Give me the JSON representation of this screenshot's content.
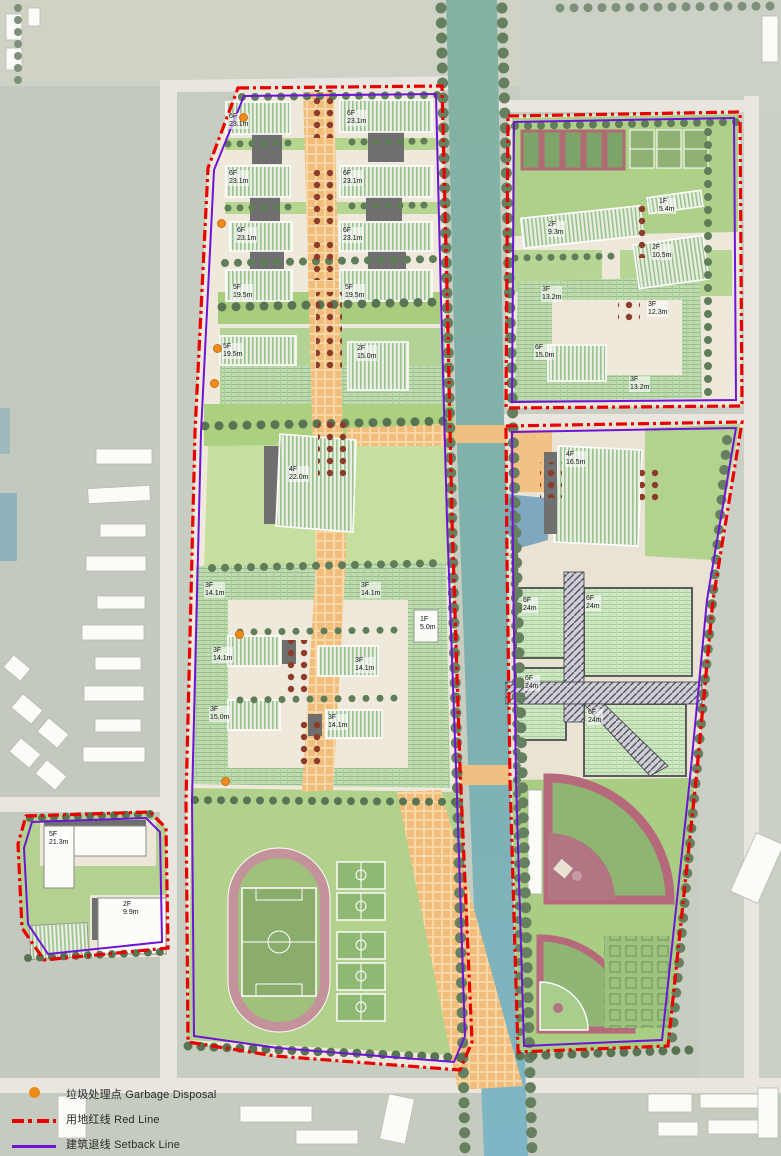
{
  "legend": {
    "items": [
      {
        "id": "garbage-disposal",
        "label_zh": "垃圾处理点",
        "label_en": "Garbage Disposal",
        "color": "#ef8b1d"
      },
      {
        "id": "red-line",
        "label_zh": "用地红线",
        "label_en": "Red Line",
        "color": "#e90000"
      },
      {
        "id": "setback-line",
        "label_zh": "建筑退线",
        "label_en": "Setback Line",
        "color": "#6d14d8"
      }
    ]
  },
  "colors": {
    "water": "#7fb0ad",
    "parcel_ground": "#efe9dc",
    "lawn": "#aed089",
    "axis_orange": "#f2bd7a",
    "track_pink": "#c4929b",
    "red_line": "#e90000",
    "setback_line": "#6d14d8",
    "garbage_dot": "#ef8b1d"
  },
  "building_labels": [
    {
      "floors": "6F",
      "height": "23.1m",
      "x": 228,
      "y": 113
    },
    {
      "floors": "6F",
      "height": "23.1m",
      "x": 346,
      "y": 110
    },
    {
      "floors": "6F",
      "height": "23.1m",
      "x": 228,
      "y": 170
    },
    {
      "floors": "6F",
      "height": "23.1m",
      "x": 342,
      "y": 170
    },
    {
      "floors": "6F",
      "height": "23.1m",
      "x": 236,
      "y": 227
    },
    {
      "floors": "6F",
      "height": "23.1m",
      "x": 342,
      "y": 227
    },
    {
      "floors": "5F",
      "height": "19.5m",
      "x": 232,
      "y": 284
    },
    {
      "floors": "5F",
      "height": "19.5m",
      "x": 344,
      "y": 284
    },
    {
      "floors": "5F",
      "height": "19.5m",
      "x": 222,
      "y": 343
    },
    {
      "floors": "2F",
      "height": "15.0m",
      "x": 356,
      "y": 345
    },
    {
      "floors": "4F",
      "height": "22.0m",
      "x": 288,
      "y": 466
    },
    {
      "floors": "3F",
      "height": "14.1m",
      "x": 204,
      "y": 582
    },
    {
      "floors": "3F",
      "height": "14.1m",
      "x": 360,
      "y": 582
    },
    {
      "floors": "1F",
      "height": "5.0m",
      "x": 419,
      "y": 616
    },
    {
      "floors": "3F",
      "height": "14.1m",
      "x": 212,
      "y": 647
    },
    {
      "floors": "3F",
      "height": "14.1m",
      "x": 354,
      "y": 657
    },
    {
      "floors": "3F",
      "height": "15.0m",
      "x": 209,
      "y": 706
    },
    {
      "floors": "3F",
      "height": "14.1m",
      "x": 327,
      "y": 714
    },
    {
      "floors": "1F",
      "height": "5.4m",
      "x": 658,
      "y": 198
    },
    {
      "floors": "2F",
      "height": "9.3m",
      "x": 547,
      "y": 221
    },
    {
      "floors": "2F",
      "height": "10.5m",
      "x": 651,
      "y": 244
    },
    {
      "floors": "3F",
      "height": "13.2m",
      "x": 541,
      "y": 286
    },
    {
      "floors": "3F",
      "height": "12.3m",
      "x": 647,
      "y": 301
    },
    {
      "floors": "6F",
      "height": "15.0m",
      "x": 534,
      "y": 344
    },
    {
      "floors": "3F",
      "height": "13.2m",
      "x": 629,
      "y": 376
    },
    {
      "floors": "4F",
      "height": "16.5m",
      "x": 565,
      "y": 451
    },
    {
      "floors": "6F",
      "height": "24m",
      "x": 522,
      "y": 597
    },
    {
      "floors": "6F",
      "height": "24m",
      "x": 585,
      "y": 595
    },
    {
      "floors": "6F",
      "height": "24m",
      "x": 524,
      "y": 675
    },
    {
      "floors": "6F",
      "height": "24m",
      "x": 587,
      "y": 709
    },
    {
      "floors": "5F",
      "height": "21.3m",
      "x": 48,
      "y": 831
    },
    {
      "floors": "2F",
      "height": "9.9m",
      "x": 122,
      "y": 901
    }
  ],
  "garbage_points": [
    [
      242,
      116
    ],
    [
      220,
      222
    ],
    [
      216,
      347
    ],
    [
      213,
      382
    ],
    [
      238,
      633
    ],
    [
      224,
      780
    ]
  ]
}
